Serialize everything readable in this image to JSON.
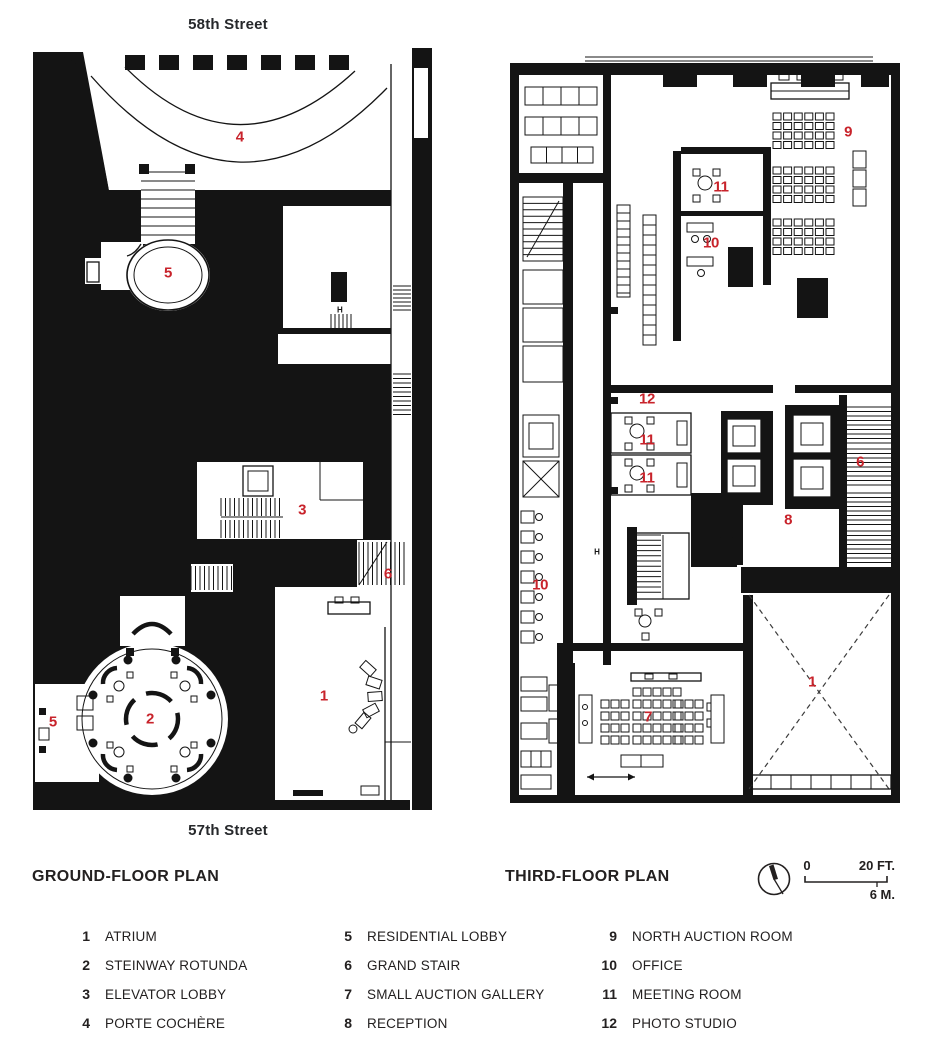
{
  "page_type": "architectural floor plans",
  "colors": {
    "ink": "#141414",
    "accent_red": "#c8232b",
    "background": "#ffffff"
  },
  "plans": [
    {
      "id": "ground",
      "title": "GROUND-FLOOR PLAN",
      "street_top": "58th Street",
      "street_bottom": "57th Street",
      "labels": [
        {
          "n": "4",
          "x": 52.4,
          "y": 12.2
        },
        {
          "n": "5",
          "x": 34.9,
          "y": 29.6
        },
        {
          "n": "3",
          "x": 67.6,
          "y": 60.0
        },
        {
          "n": "6",
          "x": 88.5,
          "y": 68.2
        },
        {
          "n": "1",
          "x": 72.9,
          "y": 83.8
        },
        {
          "n": "2",
          "x": 30.5,
          "y": 86.8
        },
        {
          "n": "5",
          "x": 6.8,
          "y": 87.2
        },
        {
          "n": "H",
          "x": 76.8,
          "y": 34.4,
          "kind": "h"
        }
      ]
    },
    {
      "id": "third",
      "title": "THIRD-FLOOR PLAN",
      "labels": [
        {
          "n": "9",
          "x": 85.8,
          "y": 10.2
        },
        {
          "n": "11",
          "x": 54.0,
          "y": 17.5
        },
        {
          "n": "10",
          "x": 51.5,
          "y": 24.9
        },
        {
          "n": "12",
          "x": 35.5,
          "y": 45.6
        },
        {
          "n": "11",
          "x": 35.5,
          "y": 51.0
        },
        {
          "n": "11",
          "x": 35.5,
          "y": 56.0
        },
        {
          "n": "6",
          "x": 88.8,
          "y": 53.9
        },
        {
          "n": "8",
          "x": 70.8,
          "y": 61.6
        },
        {
          "n": "10",
          "x": 8.8,
          "y": 70.2
        },
        {
          "n": "7",
          "x": 35.8,
          "y": 87.7
        },
        {
          "n": "1",
          "x": 76.8,
          "y": 83.0
        },
        {
          "n": "H",
          "x": 23.0,
          "y": 65.8,
          "kind": "h"
        }
      ]
    }
  ],
  "legend": {
    "columns": [
      [
        {
          "num": "1",
          "label": "ATRIUM"
        },
        {
          "num": "2",
          "label": "STEINWAY ROTUNDA"
        },
        {
          "num": "3",
          "label": "ELEVATOR LOBBY"
        },
        {
          "num": "4",
          "label": "PORTE COCHÈRE"
        }
      ],
      [
        {
          "num": "5",
          "label": "RESIDENTIAL LOBBY"
        },
        {
          "num": "6",
          "label": "GRAND STAIR"
        },
        {
          "num": "7",
          "label": "SMALL AUCTION GALLERY"
        },
        {
          "num": "8",
          "label": "RECEPTION"
        }
      ],
      [
        {
          "num": "9",
          "label": "NORTH AUCTION ROOM"
        },
        {
          "num": "10",
          "label": "OFFICE"
        },
        {
          "num": "11",
          "label": "MEETING ROOM"
        },
        {
          "num": "12",
          "label": "PHOTO STUDIO"
        }
      ]
    ]
  },
  "scale": {
    "zero": "0",
    "feet": "20 FT.",
    "meters": "6 M."
  },
  "icons": {
    "compass": "north-arrow-compass-icon"
  }
}
